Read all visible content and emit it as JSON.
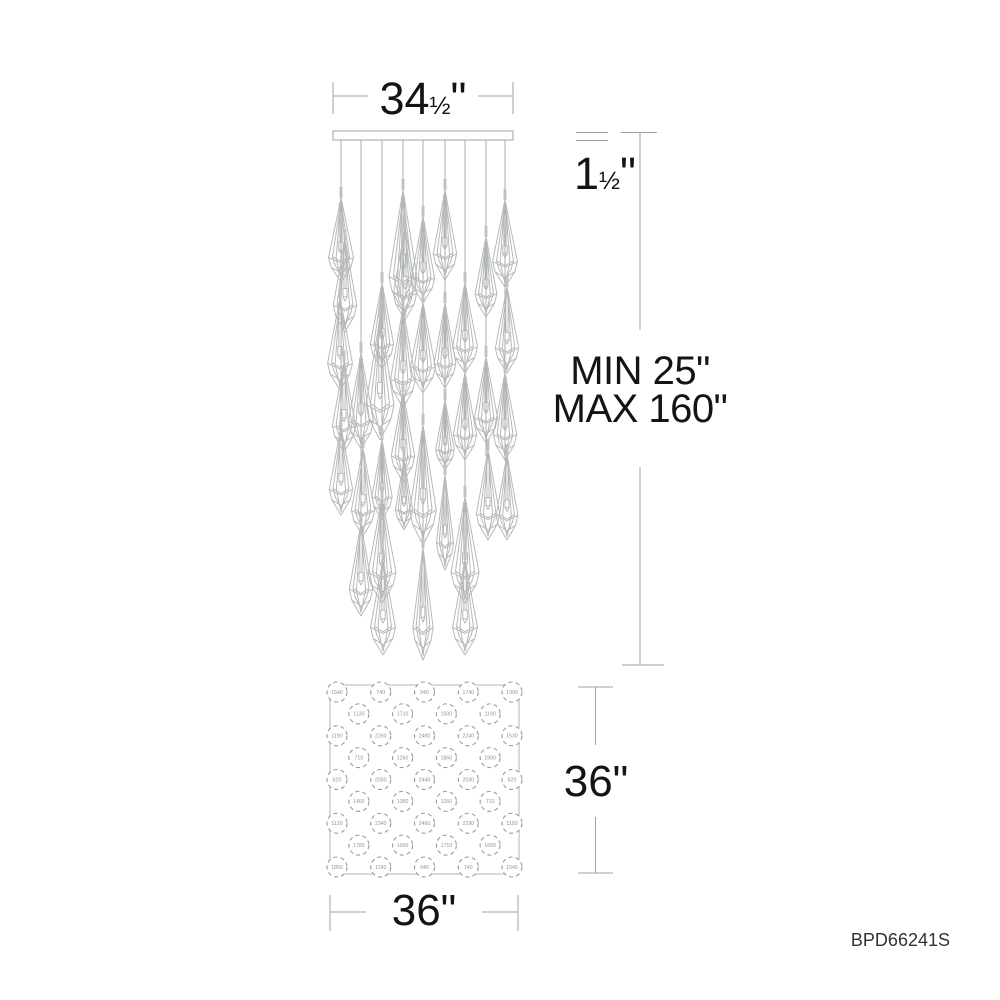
{
  "colors": {
    "background": "#ffffff",
    "fixture_line": "#b6b9bb",
    "cable_line": "#a8abad",
    "dimension_line": "#9fa2a4",
    "text": "#141414",
    "plan_line": "#969a9d"
  },
  "labels": {
    "canopy_width": {
      "main": "34",
      "frac": "½",
      "unit": "\""
    },
    "canopy_height": {
      "main": "1",
      "frac": "½",
      "unit": "\""
    },
    "drop_min": "MIN 25\"",
    "drop_max": "MAX 160\"",
    "plan_height": "36\"",
    "plan_width": "36\"",
    "product_code": "BPD66241S"
  },
  "side_view": {
    "canopy": {
      "x": 333,
      "y": 131,
      "width": 180,
      "height": 9
    },
    "columns": [
      {
        "x": 341,
        "crystals": [
          {
            "dx": 0,
            "top": 198,
            "h": 84,
            "w": 32
          },
          {
            "dx": 4,
            "top": 240,
            "h": 92,
            "w": 30
          },
          {
            "dx": -1,
            "top": 298,
            "h": 92,
            "w": 32
          },
          {
            "dx": 3,
            "top": 362,
            "h": 90,
            "w": 30
          },
          {
            "dx": 0,
            "top": 427,
            "h": 88,
            "w": 30
          }
        ]
      },
      {
        "x": 361,
        "crystals": [
          {
            "dx": 0,
            "top": 353,
            "h": 96,
            "w": 32
          },
          {
            "dx": 2,
            "top": 448,
            "h": 88,
            "w": 30
          },
          {
            "dx": 0,
            "top": 524,
            "h": 92,
            "w": 30
          }
        ]
      },
      {
        "x": 382,
        "crystals": [
          {
            "dx": 0,
            "top": 283,
            "h": 86,
            "w": 30
          },
          {
            "dx": -2,
            "top": 318,
            "h": 122,
            "w": 36
          },
          {
            "dx": 0,
            "top": 440,
            "h": 80,
            "w": 26
          },
          {
            "dx": 0,
            "top": 498,
            "h": 105,
            "w": 36
          },
          {
            "dx": 1,
            "top": 560,
            "h": 95,
            "w": 32
          }
        ]
      },
      {
        "x": 403,
        "crystals": [
          {
            "dx": 0,
            "top": 190,
            "h": 122,
            "w": 36
          },
          {
            "dx": 2,
            "top": 228,
            "h": 92,
            "w": 30
          },
          {
            "dx": 0,
            "top": 308,
            "h": 100,
            "w": 32
          },
          {
            "dx": 0,
            "top": 392,
            "h": 90,
            "w": 30
          },
          {
            "dx": 1,
            "top": 460,
            "h": 70,
            "w": 22
          }
        ]
      },
      {
        "x": 423,
        "crystals": [
          {
            "dx": 0,
            "top": 217,
            "h": 86,
            "w": 30
          },
          {
            "dx": 0,
            "top": 303,
            "h": 90,
            "w": 32
          },
          {
            "dx": 0,
            "top": 425,
            "h": 120,
            "w": 34
          },
          {
            "dx": 0,
            "top": 548,
            "h": 112,
            "w": 26
          }
        ]
      },
      {
        "x": 445,
        "crystals": [
          {
            "dx": 0,
            "top": 190,
            "h": 90,
            "w": 30
          },
          {
            "dx": 0,
            "top": 303,
            "h": 85,
            "w": 28
          },
          {
            "dx": 0,
            "top": 400,
            "h": 70,
            "w": 24
          },
          {
            "dx": 0,
            "top": 475,
            "h": 95,
            "w": 22
          }
        ]
      },
      {
        "x": 465,
        "crystals": [
          {
            "dx": 0,
            "top": 283,
            "h": 90,
            "w": 32
          },
          {
            "dx": 0,
            "top": 373,
            "h": 87,
            "w": 30
          },
          {
            "dx": 0,
            "top": 497,
            "h": 106,
            "w": 36
          },
          {
            "dx": 0,
            "top": 560,
            "h": 95,
            "w": 32
          }
        ]
      },
      {
        "x": 486,
        "crystals": [
          {
            "dx": 0,
            "top": 237,
            "h": 80,
            "w": 28
          },
          {
            "dx": 0,
            "top": 357,
            "h": 86,
            "w": 30
          },
          {
            "dx": 2,
            "top": 450,
            "h": 90,
            "w": 30
          }
        ]
      },
      {
        "x": 505,
        "crystals": [
          {
            "dx": 0,
            "top": 200,
            "h": 87,
            "w": 32
          },
          {
            "dx": 2,
            "top": 287,
            "h": 86,
            "w": 30
          },
          {
            "dx": 0,
            "top": 373,
            "h": 87,
            "w": 30
          },
          {
            "dx": 2,
            "top": 455,
            "h": 85,
            "w": 28
          }
        ]
      }
    ]
  },
  "plan_view": {
    "square": {
      "x": 330,
      "y": 685,
      "size": 189
    },
    "grid": {
      "origin_x": 337,
      "origin_y": 692,
      "spacing": 43.75
    },
    "rows": [
      {
        "offset": false,
        "labels": [
          "1540",
          "740",
          "940",
          "1740",
          "1300"
        ]
      },
      {
        "offset": true,
        "labels": [
          "1130",
          "1710",
          "1500",
          "1190"
        ]
      },
      {
        "offset": false,
        "labels": [
          "1190",
          "2260",
          "2460",
          "2240",
          "1530"
        ]
      },
      {
        "offset": true,
        "labels": [
          "710",
          "1260",
          "1860",
          "1900"
        ]
      },
      {
        "offset": false,
        "labels": [
          "620",
          "2050",
          "2440",
          "2030",
          "620"
        ]
      },
      {
        "offset": true,
        "labels": [
          "1460",
          "1360",
          "1260",
          "710"
        ]
      },
      {
        "offset": false,
        "labels": [
          "1130",
          "2340",
          "2460",
          "2290",
          "1190"
        ]
      },
      {
        "offset": true,
        "labels": [
          "1780",
          "1000",
          "1710",
          "1650"
        ]
      },
      {
        "offset": false,
        "labels": [
          "1850",
          "1190",
          "940",
          "740",
          "1540"
        ]
      }
    ]
  }
}
